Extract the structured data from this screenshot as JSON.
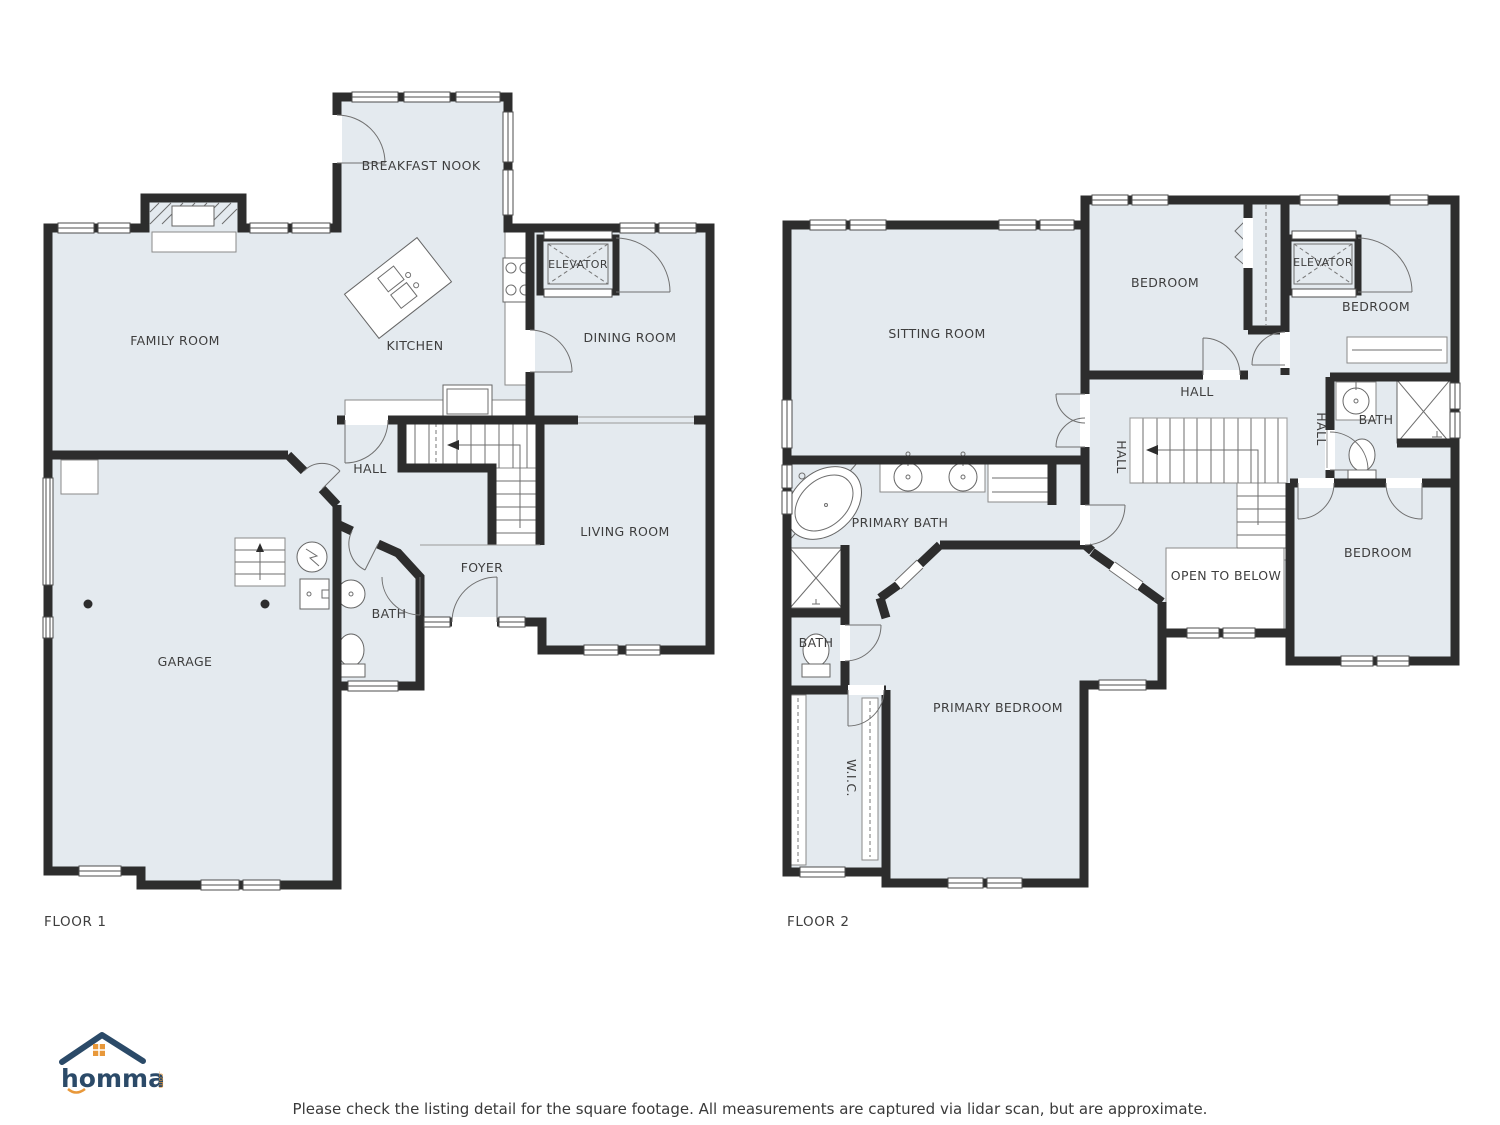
{
  "colors": {
    "floor_fill": "#e4eaef",
    "wall": "#2d2d2d",
    "logo_navy": "#2b4a68",
    "logo_orange": "#e8983a",
    "label_text": "#3e3e3e"
  },
  "floor1": {
    "title": "FLOOR 1",
    "rooms": {
      "breakfast_nook": "BREAKFAST NOOK",
      "family_room": "FAMILY ROOM",
      "kitchen": "KITCHEN",
      "elevator": "ELEVATOR",
      "dining_room": "DINING ROOM",
      "hall": "HALL",
      "living_room": "LIVING ROOM",
      "foyer": "FOYER",
      "bath": "BATH",
      "garage": "GARAGE"
    }
  },
  "floor2": {
    "title": "FLOOR 2",
    "rooms": {
      "sitting_room": "SITTING ROOM",
      "bedroom_top": "BEDROOM",
      "elevator": "ELEVATOR",
      "bedroom_right": "BEDROOM",
      "hall": "HALL",
      "hall_west": "HALL",
      "hall_east": "HALL",
      "bath": "BATH",
      "primary_bath": "PRIMARY BATH",
      "open_to_below": "OPEN TO BELOW",
      "bedroom_bottom": "BEDROOM",
      "bath_small": "BATH",
      "wic": "W.I.C.",
      "primary_bedroom": "PRIMARY BEDROOM"
    }
  },
  "footer": {
    "brand": "hommati",
    "brand_suffix": ".com",
    "disclaimer": "Please check the listing detail for the square footage. All measurements are captured via lidar scan, but are approximate."
  }
}
